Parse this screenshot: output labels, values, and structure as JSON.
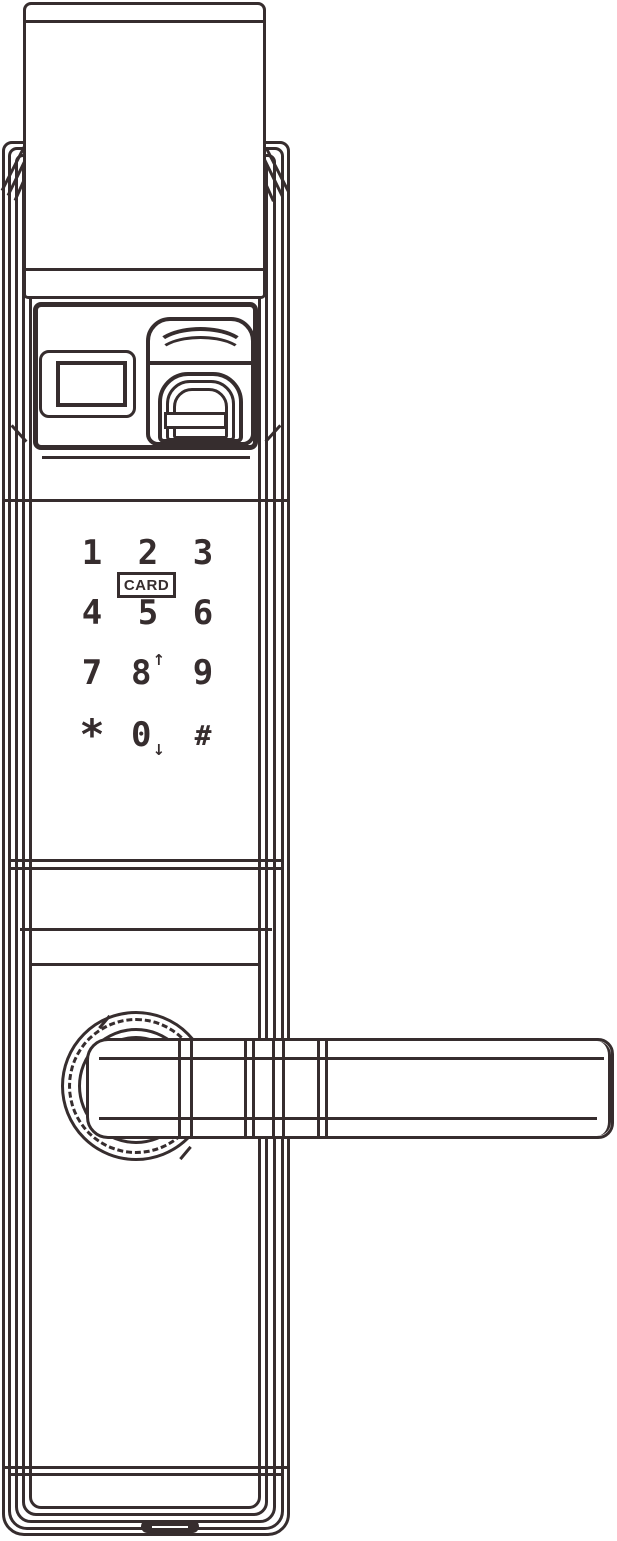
{
  "colors": {
    "line": "#362d2e",
    "background": "#ffffff"
  },
  "card_reader": {
    "label": "CARD"
  },
  "keypad": {
    "keys": [
      {
        "label": "1"
      },
      {
        "label": "2"
      },
      {
        "label": "3"
      },
      {
        "label": "4"
      },
      {
        "label": "5"
      },
      {
        "label": "6"
      },
      {
        "label": "7"
      },
      {
        "label": "8",
        "suffix": "↑"
      },
      {
        "label": "9"
      },
      {
        "label": "*"
      },
      {
        "label": "0",
        "suffix": "↓"
      },
      {
        "label": "#"
      }
    ]
  }
}
